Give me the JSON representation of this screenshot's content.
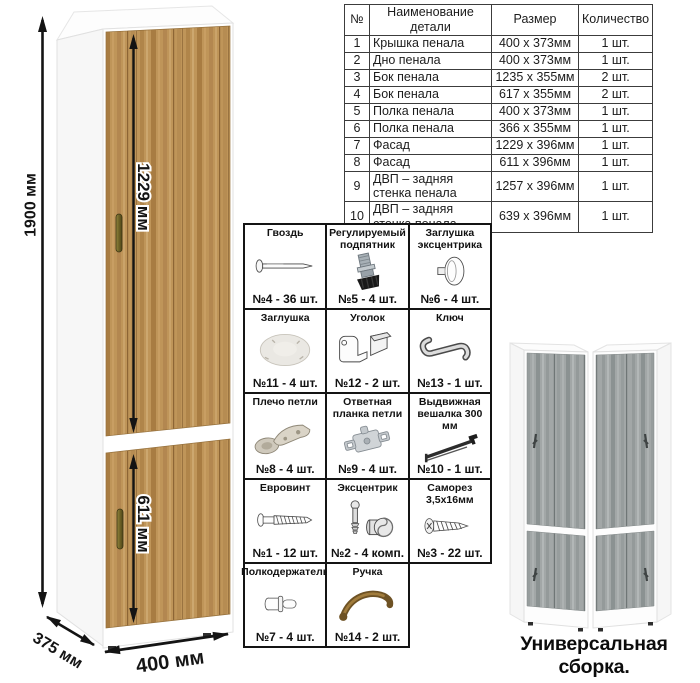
{
  "illustration": {
    "dim_height": "1900 мм",
    "dim_upper_door": "1229 мм",
    "dim_lower_door": "611 мм",
    "dim_depth": "375 мм",
    "dim_width": "400 мм"
  },
  "parts_table": {
    "headers": [
      "№",
      "Наименование детали",
      "Размер",
      "Количество"
    ],
    "rows": [
      {
        "num": "1",
        "name": "Крышка пенала",
        "size": "400 х 373мм",
        "qty": "1 шт."
      },
      {
        "num": "2",
        "name": "Дно пенала",
        "size": "400 х 373мм",
        "qty": "1 шт."
      },
      {
        "num": "3",
        "name": "Бок пенала",
        "size": "1235 х 355мм",
        "qty": "2 шт."
      },
      {
        "num": "4",
        "name": "Бок пенала",
        "size": "617 х 355мм",
        "qty": "2 шт."
      },
      {
        "num": "5",
        "name": "Полка пенала",
        "size": "400 х 373мм",
        "qty": "1 шт."
      },
      {
        "num": "6",
        "name": "Полка пенала",
        "size": "366 х 355мм",
        "qty": "1 шт."
      },
      {
        "num": "7",
        "name": "Фасад",
        "size": "1229 х 396мм",
        "qty": "1 шт."
      },
      {
        "num": "8",
        "name": "Фасад",
        "size": "611 х 396мм",
        "qty": "1 шт."
      },
      {
        "num": "9",
        "name": "ДВП – задняя стенка пенала",
        "size": "1257 х 396мм",
        "qty": "1 шт."
      },
      {
        "num": "10",
        "name": "ДВП – задняя стенка пенала",
        "size": "639 х 396мм",
        "qty": "1 шт."
      }
    ]
  },
  "hardware": {
    "items": [
      {
        "title": "Гвоздь",
        "count": "№4 - 36 шт.",
        "icon": "nail-icon"
      },
      {
        "title": "Регулируемый подпятник",
        "count": "№5 - 4 шт.",
        "icon": "adjustable-foot-icon"
      },
      {
        "title": "Заглушка эксцентрика",
        "count": "№6 - 4 шт.",
        "icon": "cam-cap-icon"
      },
      {
        "title": "Заглушка",
        "count": "№11 - 4 шт.",
        "icon": "cover-cap-icon"
      },
      {
        "title": "Уголок",
        "count": "№12 - 2 шт.",
        "icon": "corner-bracket-icon"
      },
      {
        "title": "Ключ",
        "count": "№13 - 1 шт.",
        "icon": "hex-key-icon"
      },
      {
        "title": "Плечо петли",
        "count": "№8 - 4 шт.",
        "icon": "hinge-arm-icon"
      },
      {
        "title": "Ответная планка петли",
        "count": "№9 - 4 шт.",
        "icon": "hinge-plate-icon"
      },
      {
        "title": "Выдвижная вешалка 300 мм",
        "count": "№10 - 1 шт.",
        "icon": "pullout-hanger-icon"
      },
      {
        "title": "Евровинт",
        "count": "№1 - 12 шт.",
        "icon": "euro-screw-icon"
      },
      {
        "title": "Эксцентрик",
        "count": "№2 - 4 комп.",
        "icon": "cam-lock-icon"
      },
      {
        "title": "Саморез 3,5х16мм",
        "count": "№3 - 22 шт.",
        "icon": "self-tapping-screw-icon"
      },
      {
        "title": "Полкодержатель",
        "count": "№7 - 4 шт.",
        "icon": "shelf-pin-icon"
      },
      {
        "title": "Ручка",
        "count": "№14 - 2 шт.",
        "icon": "handle-icon"
      }
    ]
  },
  "variants": {
    "caption": "Универсальная сборка."
  },
  "colors": {
    "wood": "#bf9559",
    "wood_dark": "#8d6535",
    "gray_wood": "#a2a7a7",
    "line": "#141414",
    "brass_handle": "#81742f"
  }
}
